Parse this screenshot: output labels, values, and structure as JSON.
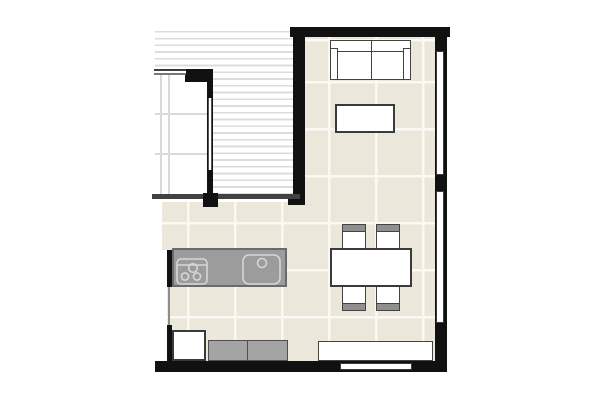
{
  "title": "Apartment floor plan (cropped)",
  "palette": {
    "wall": "#111111",
    "outline": "#434343",
    "floor": "#ece7db",
    "tile-line": "#faf9f4",
    "deck-stripe": "#dcdcdc",
    "room-grid": "#d9d9d9",
    "counter": "#9c9c9c",
    "counter-edge": "#6b6b6b",
    "cabinet": "#a4a4a4",
    "chair-back": "#8f8f8f",
    "appliance-line": "#d6d6d6",
    "paper": "#ffffff"
  },
  "rooms": [
    {
      "name": "deck-terrace",
      "style": "striped decking, partially visible top-left"
    },
    {
      "name": "adjacent-room",
      "style": "white floor with light grid, partially visible left"
    },
    {
      "name": "living-dining-kitchen",
      "style": "beige tile floor with white grout grid"
    }
  ],
  "furniture": [
    {
      "name": "sofa",
      "desc": "two-seat sofa with armrests against top wall"
    },
    {
      "name": "coffee-table",
      "desc": "rectangular table below sofa"
    },
    {
      "name": "dining-table",
      "desc": "rectangular table with 4 chairs"
    },
    {
      "name": "dining-chair",
      "count": 4
    },
    {
      "name": "kitchen-counter",
      "desc": "gray counter with cooktop (3 burners) and sink"
    },
    {
      "name": "kitchen-appliance",
      "desc": "white base unit bottom-left"
    },
    {
      "name": "base-cabinet",
      "count": 2,
      "desc": "gray cabinets along bottom wall"
    },
    {
      "name": "sideboard",
      "desc": "long white unit along bottom wall, right side"
    }
  ],
  "openings": [
    {
      "name": "window-right-upper",
      "wall": "right"
    },
    {
      "name": "window-right-lower",
      "wall": "right"
    },
    {
      "name": "window-bottom",
      "wall": "bottom"
    },
    {
      "name": "window-adjacent-room",
      "wall": "interior left"
    },
    {
      "name": "glass-door-terrace",
      "wall": "between terrace and living area"
    }
  ]
}
